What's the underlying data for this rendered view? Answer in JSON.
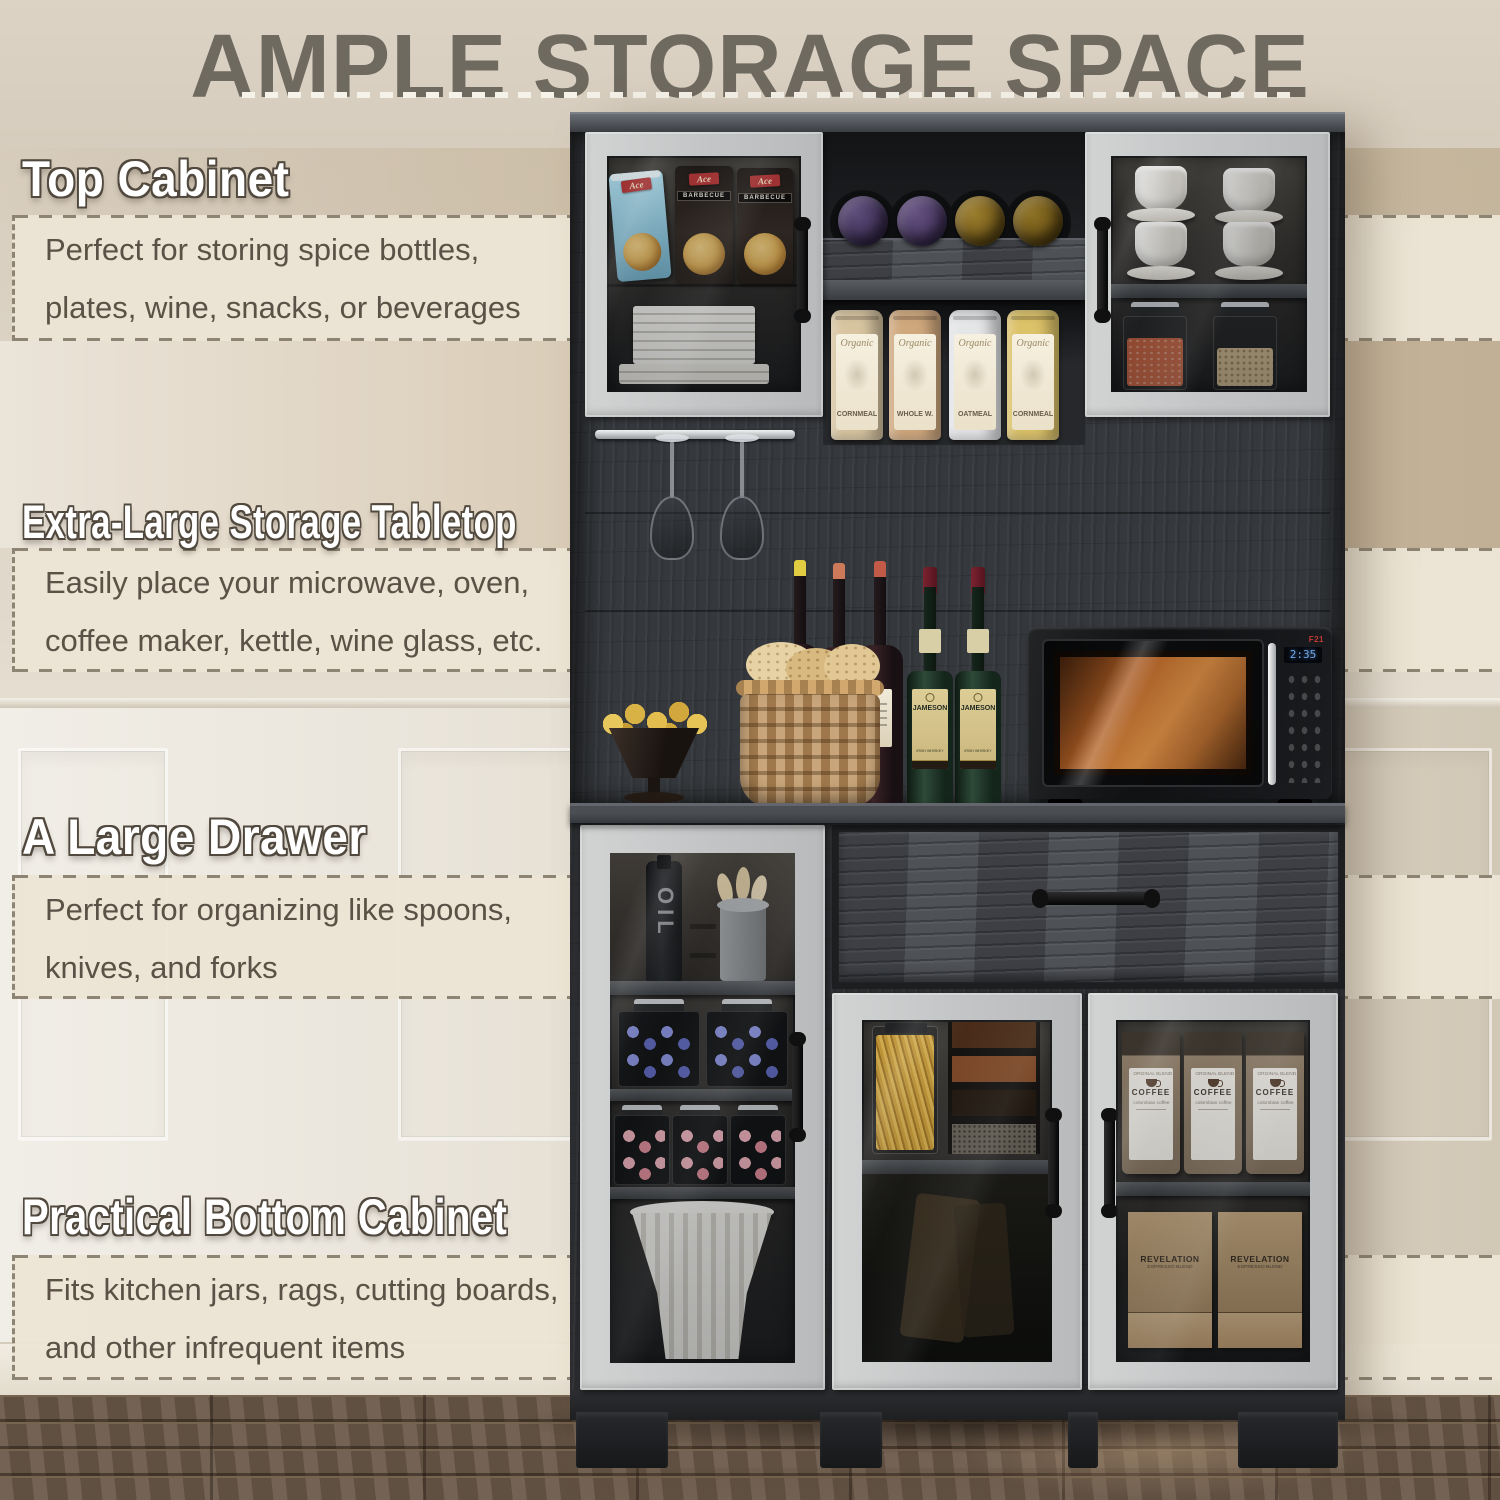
{
  "title": {
    "text": "AMPLE STORAGE SPACE"
  },
  "callouts": [
    {
      "heading": "Top Cabinet",
      "body": "Perfect for storing spice bottles,\nplates, wine, snacks, or beverages"
    },
    {
      "heading": "Extra-Large Storage Tabletop",
      "body": "Easily place your microwave, oven,\ncoffee maker, kettle, wine glass, etc."
    },
    {
      "heading": "A Large Drawer",
      "body": "Perfect for organizing like spoons,\nknives, and forks"
    },
    {
      "heading": "Practical Bottom Cabinet",
      "body": "Fits kitchen jars, rags, cutting boards,\nand other infrequent items"
    }
  ],
  "cabinet": {
    "chip_bags": {
      "brand": "Ace",
      "flavor": "BARBECUE"
    },
    "canisters": [
      {
        "script": "Organic",
        "name": "CORNMEAL"
      },
      {
        "script": "Organic",
        "name": "WHOLE W."
      },
      {
        "script": "Organic",
        "name": "OATMEAL"
      },
      {
        "script": "Organic",
        "name": "CORNMEAL"
      }
    ],
    "whiskey": {
      "brand": "JAMESON",
      "type": "IRISH WHISKEY"
    },
    "oil_bottle": "OIL",
    "microwave": {
      "display": "2:35",
      "brand": "F21"
    },
    "coffee_bags": {
      "line1": "ORGINAL BLEND",
      "line2": "COFFEE",
      "line3": "colombian coffee"
    },
    "coffee_boxes": {
      "line1": "REVELATION",
      "line2": "ESPRESSO BLEND"
    }
  },
  "colors": {
    "wall_beige": "#d8cec0",
    "wall_tan": "#c2b096",
    "band_bg": "#ece4d4",
    "band_border": "#8d8473",
    "title_text": "#6f6a60",
    "heading_fill": "#ffffff",
    "heading_outline": "#51493e",
    "body_text": "#5c5146",
    "cabinet_dark": "#35383c",
    "door_gray": "#c9cbcc",
    "floor_brown": "#6b5949",
    "microwave_glow": "#d98d44"
  }
}
